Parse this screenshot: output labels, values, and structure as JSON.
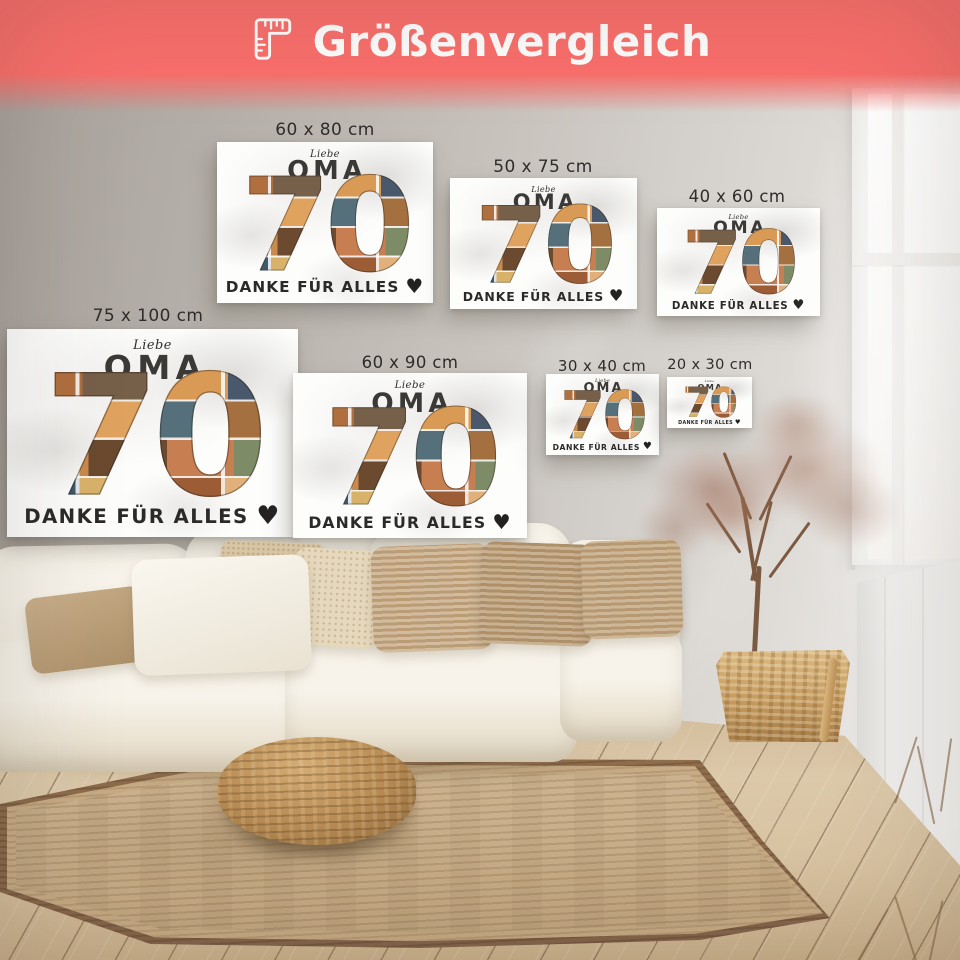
{
  "header": {
    "title": "Größenvergleich",
    "icon": "ruler",
    "background_color": "#fb6f6c",
    "text_color": "#ffffff"
  },
  "artwork": {
    "script_word": "Liebe",
    "recipient": "OMA",
    "number": "70",
    "message": "DANKE FÜR ALLES",
    "heart": "♥"
  },
  "size_labels": [
    "60 x 80 cm",
    "50 x 75 cm",
    "40 x 60 cm",
    "75 x 100 cm",
    "60 x 90 cm",
    "30 x 40 cm",
    "20 x 30 cm"
  ]
}
